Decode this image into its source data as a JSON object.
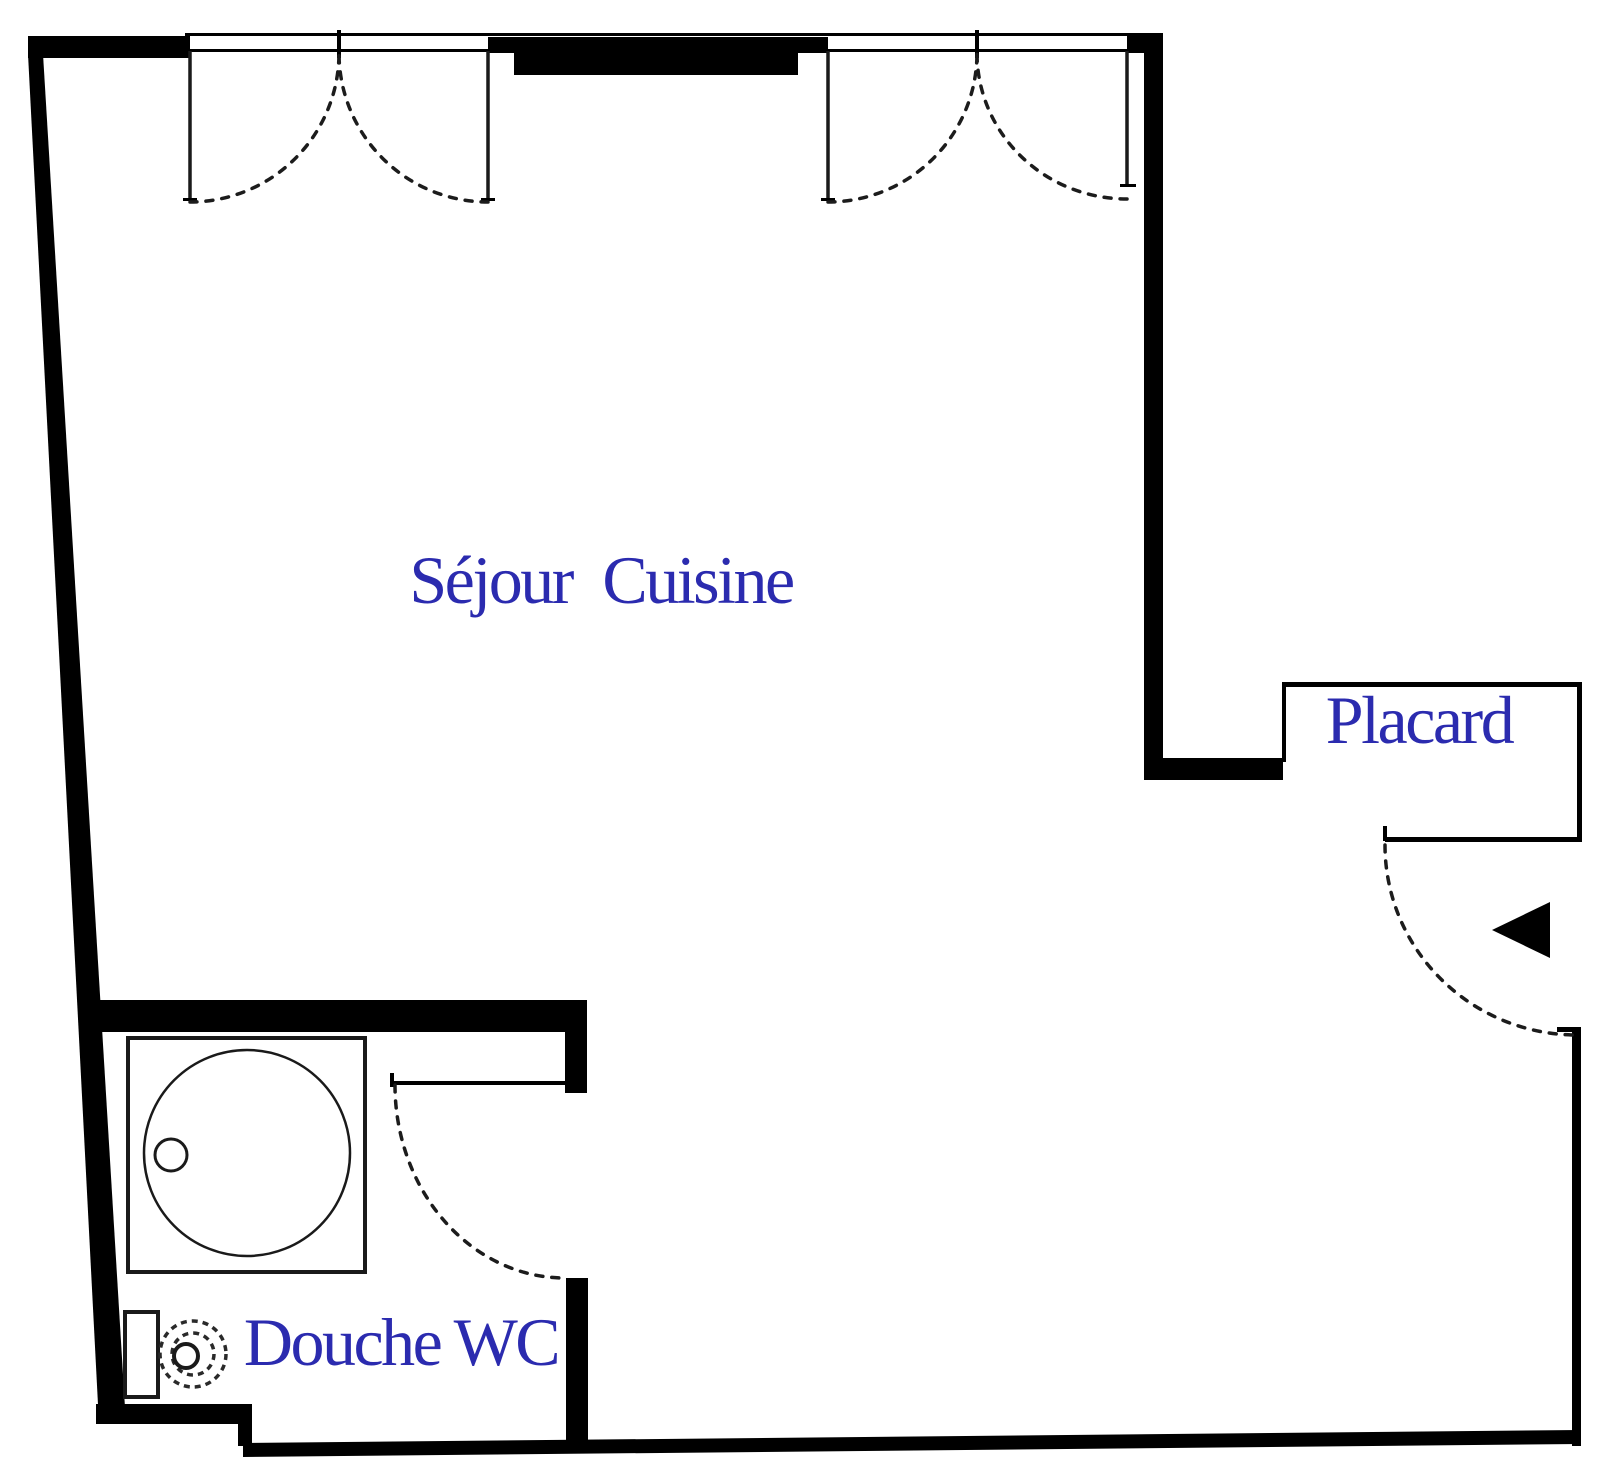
{
  "plan": {
    "type": "floor-plan",
    "background_color": "#ffffff",
    "wall_color": "#000000",
    "label_color": "#2b2baf",
    "rooms": [
      {
        "id": "sejour-cuisine",
        "label": "Séjour Cuisine"
      },
      {
        "id": "placard",
        "label": "Placard"
      },
      {
        "id": "douche-wc",
        "label": "Douche WC"
      }
    ],
    "fixtures": [
      {
        "id": "shower-tray",
        "description": "square shower tray with round basin and drain"
      },
      {
        "id": "toilet",
        "description": "toilet with tank and round bowl"
      }
    ],
    "doors": [
      {
        "id": "window-1",
        "style": "double-leaf french window, dashed swing arcs"
      },
      {
        "id": "window-2",
        "style": "double-leaf french window, dashed swing arcs"
      },
      {
        "id": "entrance-door",
        "style": "single leaf, dashed swing arc, black arrow marker"
      },
      {
        "id": "bathroom-door",
        "style": "single leaf, dashed swing arc"
      }
    ]
  }
}
